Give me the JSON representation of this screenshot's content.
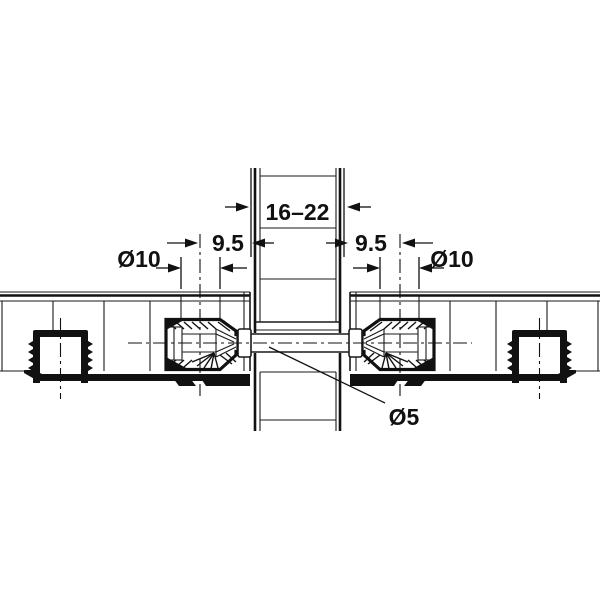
{
  "drawing": {
    "kind": "furniture-connector-cross-section",
    "labels": {
      "panel_thickness": "16–22",
      "offset_left": "9.5",
      "offset_right": "9.5",
      "hole_left": "Ø10",
      "hole_right": "Ø10",
      "bolt": "Ø5"
    },
    "colors": {
      "ink": "#1a1a1a",
      "background": "#ffffff"
    }
  }
}
